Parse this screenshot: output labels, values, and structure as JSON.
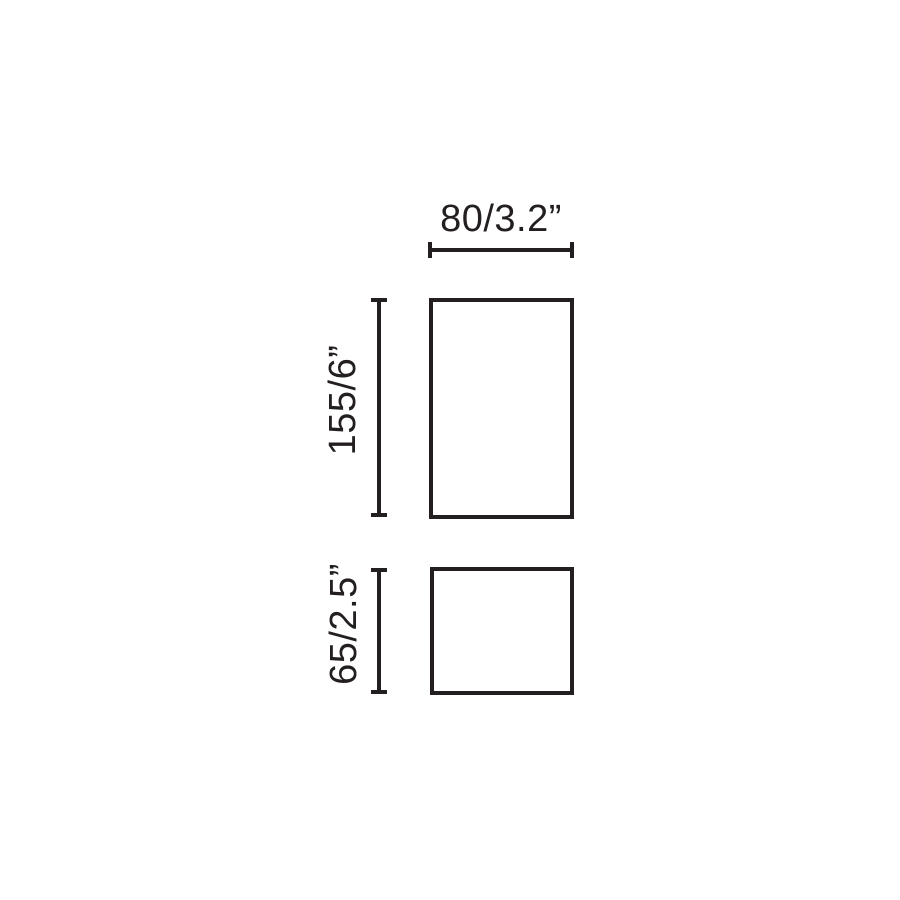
{
  "page": {
    "background": "#ffffff"
  },
  "diagram": {
    "type": "dimension-drawing",
    "ink_color": "#231f20",
    "shapes": [
      {
        "name": "body-outline",
        "description": "tall rectangle (front view)"
      },
      {
        "name": "base-outline",
        "description": "short rectangle (side/base view)"
      }
    ],
    "dimensions": [
      {
        "id": "width",
        "label": "80/3.2”",
        "orientation": "horizontal",
        "applies_to": "body-outline"
      },
      {
        "id": "body-height",
        "label": "155/6”",
        "orientation": "vertical",
        "applies_to": "body-outline"
      },
      {
        "id": "base-height",
        "label": "65/2.5”",
        "orientation": "vertical",
        "applies_to": "base-outline"
      }
    ]
  }
}
